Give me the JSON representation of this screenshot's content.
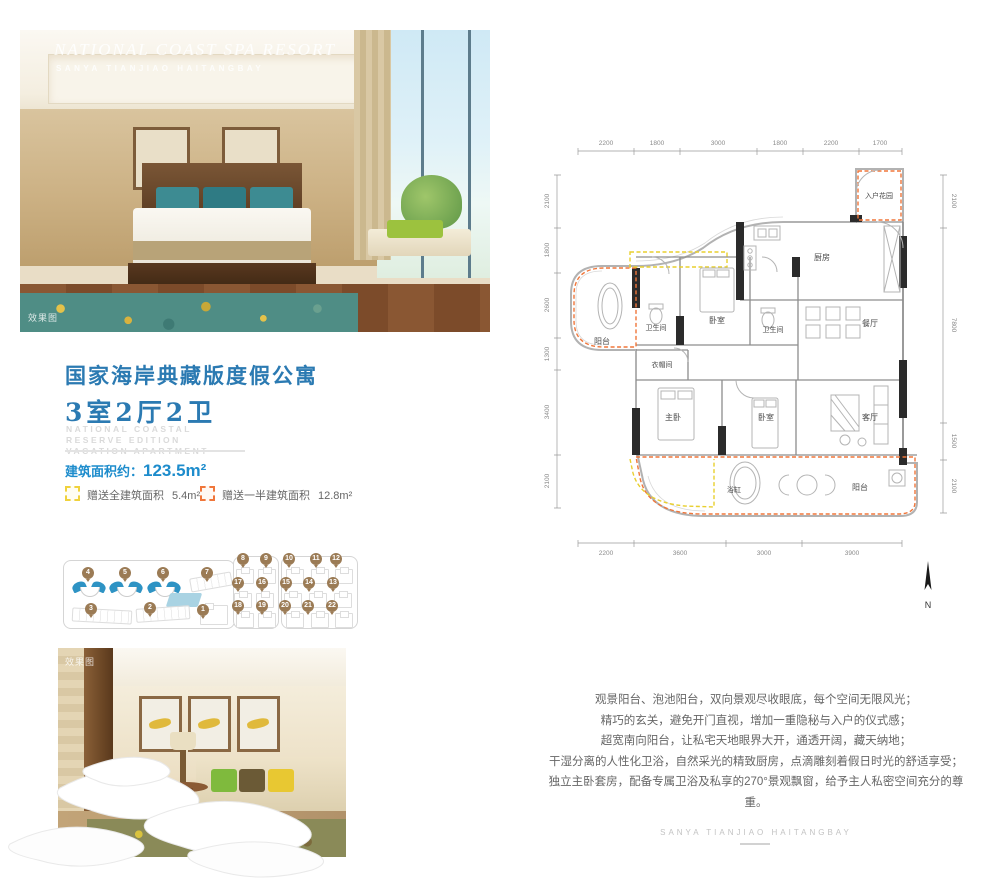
{
  "hero_photo": {
    "overlay_title": "NATIONAL COAST SPA RESORT",
    "overlay_subtitle": "SANYA TIANJIAO HAITANGBAY",
    "watermark": "效果图"
  },
  "title_block": {
    "title": "国家海岸典藏版度假公寓",
    "layout": "3室2厅2卫",
    "english_lines": [
      "NATIONAL COASTAL",
      "RESERVE EDITION",
      "VACATION APARTMENT"
    ]
  },
  "area_info": {
    "label": "建筑面积约：",
    "value": "123.5m²",
    "legend": [
      {
        "label": "赠送全建筑面积",
        "value": "5.4m²",
        "color": "#f0d23c"
      },
      {
        "label": "赠送一半建筑面积",
        "value": "12.8m²",
        "color": "#f0763a"
      }
    ]
  },
  "floor_plan": {
    "dims_top": [
      "2200",
      "1800",
      "3000",
      "1800",
      "2200",
      "1700"
    ],
    "dims_left": [
      "2100",
      "1800",
      "2600",
      "1300",
      "3400",
      "2100"
    ],
    "dims_right": [
      "2100",
      "7800",
      "1500",
      "2100"
    ],
    "dims_bottom": [
      "2200",
      "3600",
      "3000",
      "3900"
    ],
    "rooms": [
      "入户花园",
      "厨房",
      "卫生间",
      "卧室",
      "卫生间",
      "餐厅",
      "阳台",
      "衣帽间",
      "主卧",
      "卧室",
      "客厅",
      "浴缸",
      "阳台"
    ],
    "north_label": "N",
    "gift_full_color": "#f0d23c",
    "gift_half_color": "#f0763a"
  },
  "site_plan": {
    "left_pins": [
      "4",
      "5",
      "6",
      "7",
      "3",
      "2",
      "1"
    ],
    "right_pins": [
      "8",
      "9",
      "10",
      "11",
      "12",
      "17",
      "16",
      "15",
      "14",
      "13",
      "18",
      "19",
      "20",
      "21",
      "22"
    ]
  },
  "bottom_photo": {
    "watermark": "效果图"
  },
  "description": {
    "lines": [
      "观景阳台、泡池阳台，双向景观尽收眼底，每个空间无限风光；",
      "精巧的玄关，避免开门直视，增加一重隐秘与入户的仪式感；",
      "超宽南向阳台，让私宅天地眼界大开，通透开阔，藏天纳地；",
      "干湿分离的人性化卫浴，自然采光的精致厨房，点滴雕刻着假日时光的舒适享受；",
      "独立主卧套房，配备专属卫浴及私享的270°景观飘窗，给予主人私密空间充分的尊重。"
    ]
  },
  "footer": {
    "text": "SANYA TIANJIAO HAITANGBAY"
  }
}
